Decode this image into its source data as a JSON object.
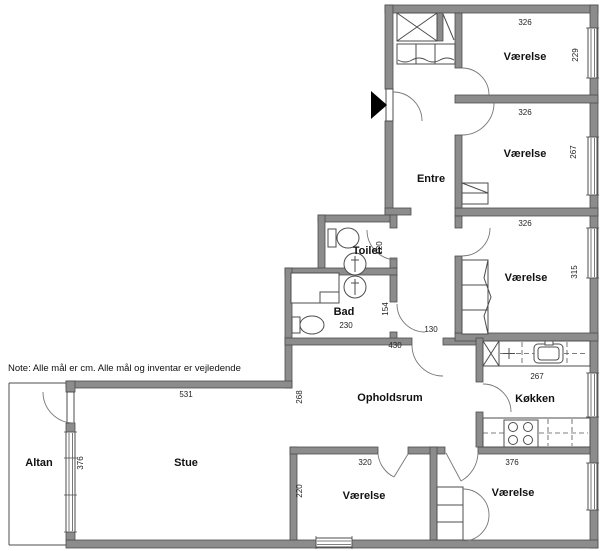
{
  "note": "Note: Alle mål er cm. Alle mål og inventar er vejledende",
  "rooms": {
    "vaerelse_top": "Værelse",
    "vaerelse_mid": "Værelse",
    "vaerelse_lower": "Værelse",
    "entre": "Entre",
    "toilet": "Toilet",
    "bad": "Bad",
    "opholdsrum": "Opholdsrum",
    "koekken": "Køkken",
    "stue": "Stue",
    "altan": "Altan",
    "vaerelse_bottom_left": "Værelse",
    "vaerelse_bottom_right": "Værelse"
  },
  "dimensions_cm": {
    "vaerelse_top_w": "326",
    "vaerelse_top_h": "229",
    "vaerelse_mid_w": "326",
    "vaerelse_mid_h": "267",
    "vaerelse_lower_w": "326",
    "vaerelse_lower_h": "315",
    "toilet_h": "120",
    "bad_h": "154",
    "bad_w": "230",
    "gang_w": "130",
    "opholdsrum_w": "430",
    "opholdsrum_h": "268",
    "koekken_w": "267",
    "stue_w": "531",
    "stue_h": "376",
    "vaerelse_bl_w": "320",
    "vaerelse_bl_h": "220",
    "vaerelse_br_w": "376"
  },
  "colors": {
    "wall": "#8c8c8c",
    "wall_stroke": "#4d4d4d",
    "line": "#4d4d4d",
    "arrow": "#000000",
    "background": "#ffffff"
  }
}
